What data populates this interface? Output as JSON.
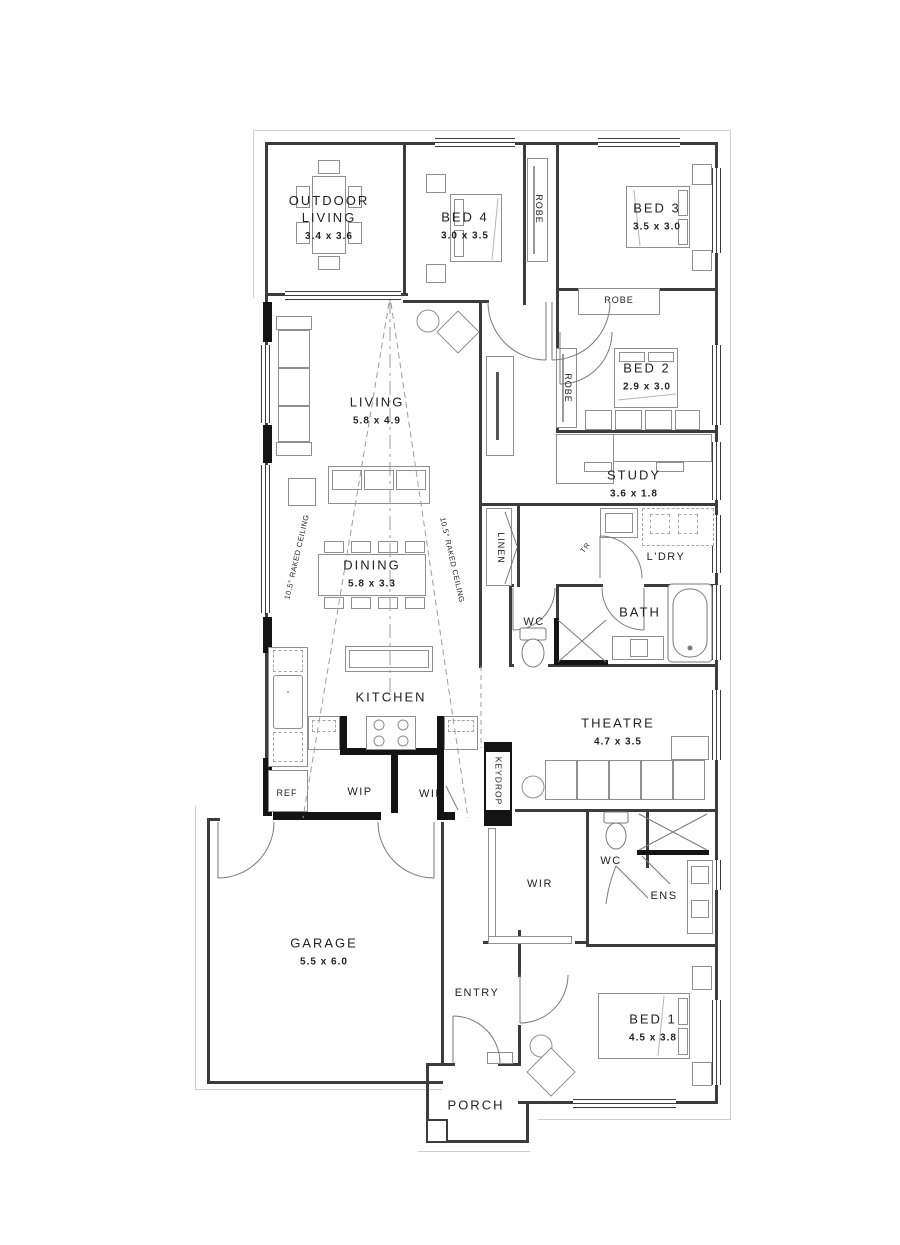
{
  "plan": {
    "rooms": {
      "outdoor_living": {
        "name": "OUTDOOR LIVING",
        "dims": "3.4 x 3.6"
      },
      "bed4": {
        "name": "BED 4",
        "dims": "3.0 x 3.5"
      },
      "bed3": {
        "name": "BED 3",
        "dims": "3.5 x 3.0"
      },
      "bed2": {
        "name": "BED 2",
        "dims": "2.9 x 3.0"
      },
      "bed1": {
        "name": "BED 1",
        "dims": "4.5 x 3.8"
      },
      "study": {
        "name": "STUDY",
        "dims": "3.6 x 1.8"
      },
      "living": {
        "name": "LIVING",
        "dims": "5.8 x 4.9"
      },
      "dining": {
        "name": "DINING",
        "dims": "5.8 x 3.3"
      },
      "theatre": {
        "name": "THEATRE",
        "dims": "4.7 x 3.5"
      },
      "garage": {
        "name": "GARAGE",
        "dims": "5.5 x 6.0"
      },
      "kitchen": {
        "name": "KITCHEN"
      },
      "entry": {
        "name": "ENTRY"
      },
      "porch": {
        "name": "PORCH"
      },
      "bath": {
        "name": "BATH"
      },
      "ldry": {
        "name": "L'DRY"
      },
      "linen": {
        "name": "LINEN"
      },
      "wc_main": {
        "name": "WC"
      },
      "wc_ens": {
        "name": "WC"
      },
      "ens": {
        "name": "ENS"
      },
      "wir": {
        "name": "WIR"
      },
      "wip": {
        "name": "WIP"
      },
      "wil": {
        "name": "WIL"
      },
      "ref": {
        "name": "REF"
      },
      "keydrop": {
        "name": "KEYDROP"
      },
      "robe_bed4": {
        "name": "ROBE"
      },
      "robe_bed3": {
        "name": "ROBE"
      },
      "robe_bed2": {
        "name": "ROBE"
      },
      "tr": {
        "name": "TR"
      }
    },
    "annotations": {
      "raked_left": "10.5° RAKED CEILING",
      "raked_right": "10.5° RAKED CEILING"
    },
    "colors": {
      "wall": "#141414",
      "line": "#3c3c3c",
      "furniture": "#8f8f8f",
      "text": "#222222",
      "background": "#ffffff"
    }
  }
}
